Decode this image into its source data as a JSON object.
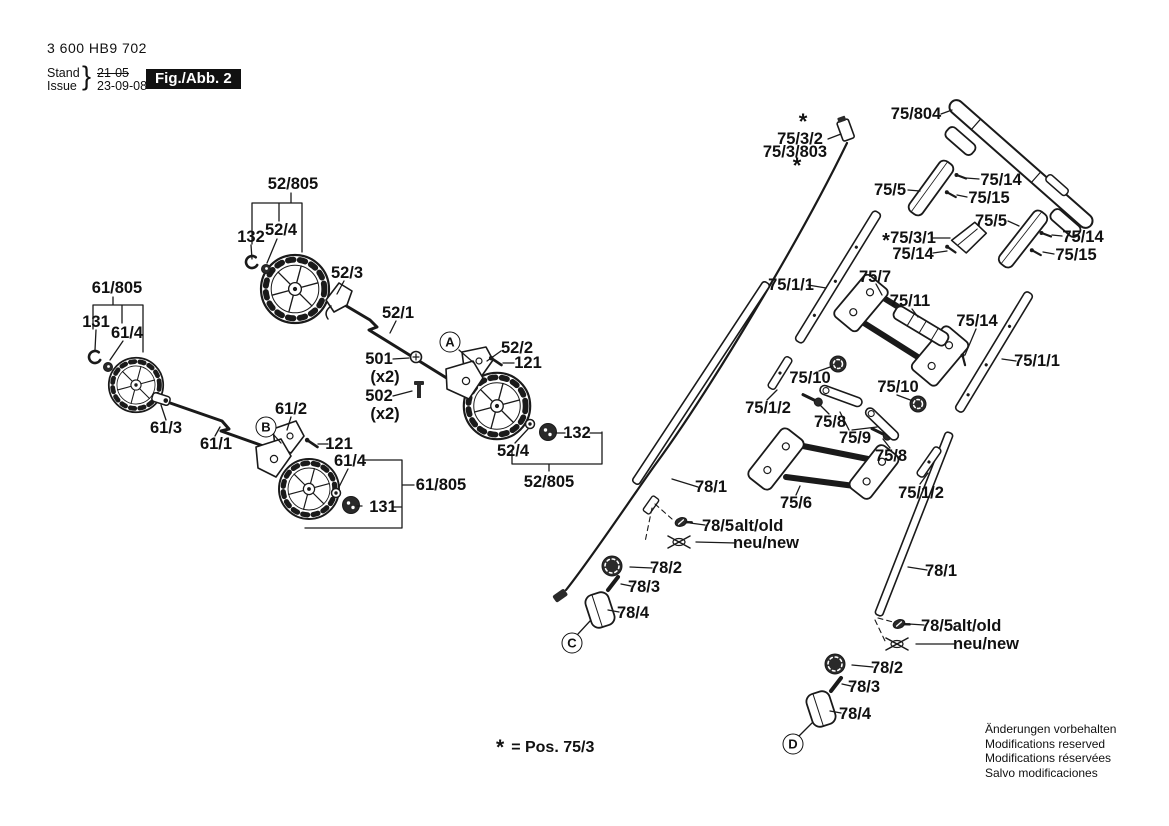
{
  "header": {
    "part_number": "3 600 HB9 702",
    "stand_label": "Stand",
    "issue_label": "Issue",
    "brace": "}",
    "stand_value": "21-05",
    "issue_value": "23-09-08",
    "figure_label": "Fig./Abb. 2"
  },
  "legend": {
    "symbol": "*",
    "text": "= Pos. 75/3"
  },
  "notes": [
    "Änderungen vorbehalten",
    "Modifications reserved",
    "Modifications réservées",
    "Salvo modificaciones"
  ],
  "colors": {
    "ink": "#1a1a1a",
    "figure_box_bg": "#111111"
  },
  "callouts": [
    {
      "letter": "A",
      "x": 450,
      "y": 342
    },
    {
      "letter": "B",
      "x": 266,
      "y": 427
    },
    {
      "letter": "C",
      "x": 572,
      "y": 643
    },
    {
      "letter": "D",
      "x": 793,
      "y": 744
    }
  ],
  "labels": [
    {
      "text": "52/805",
      "x": 293,
      "y": 184
    },
    {
      "text": "132",
      "x": 251,
      "y": 237
    },
    {
      "text": "52/4",
      "x": 281,
      "y": 230
    },
    {
      "text": "52/3",
      "x": 347,
      "y": 273
    },
    {
      "text": "52/1",
      "x": 398,
      "y": 313
    },
    {
      "text": "501",
      "x": 379,
      "y": 359
    },
    {
      "text": "(x2)",
      "x": 385,
      "y": 377
    },
    {
      "text": "502",
      "x": 379,
      "y": 396
    },
    {
      "text": "(x2)",
      "x": 385,
      "y": 414
    },
    {
      "text": "52/2",
      "x": 517,
      "y": 348
    },
    {
      "text": "121",
      "x": 528,
      "y": 363
    },
    {
      "text": "132",
      "x": 577,
      "y": 433
    },
    {
      "text": "52/4",
      "x": 513,
      "y": 451
    },
    {
      "text": "52/805",
      "x": 549,
      "y": 482
    },
    {
      "text": "61/805",
      "x": 117,
      "y": 288
    },
    {
      "text": "131",
      "x": 96,
      "y": 322
    },
    {
      "text": "61/4",
      "x": 127,
      "y": 333
    },
    {
      "text": "61/3",
      "x": 166,
      "y": 428
    },
    {
      "text": "61/1",
      "x": 216,
      "y": 444
    },
    {
      "text": "61/2",
      "x": 291,
      "y": 409
    },
    {
      "text": "121",
      "x": 339,
      "y": 444
    },
    {
      "text": "61/4",
      "x": 350,
      "y": 461
    },
    {
      "text": "61/805",
      "x": 441,
      "y": 485
    },
    {
      "text": "131",
      "x": 383,
      "y": 507
    },
    {
      "text": "*",
      "x": 803,
      "y": 122,
      "size": 22
    },
    {
      "text": "75/3/2",
      "x": 800,
      "y": 139
    },
    {
      "text": "75/3/803",
      "x": 795,
      "y": 152
    },
    {
      "text": "*",
      "x": 797,
      "y": 166,
      "size": 22
    },
    {
      "text": "75/804",
      "x": 916,
      "y": 114
    },
    {
      "text": "75/5",
      "x": 890,
      "y": 190
    },
    {
      "text": "75/14",
      "x": 1001,
      "y": 180
    },
    {
      "text": "75/15",
      "x": 989,
      "y": 198
    },
    {
      "text": "75/5",
      "x": 991,
      "y": 221
    },
    {
      "text": "*",
      "x": 886,
      "y": 241,
      "size": 20
    },
    {
      "text": "75/3/1",
      "x": 913,
      "y": 238
    },
    {
      "text": "75/14",
      "x": 913,
      "y": 254
    },
    {
      "text": "75/14",
      "x": 1083,
      "y": 237
    },
    {
      "text": "75/15",
      "x": 1076,
      "y": 255
    },
    {
      "text": "75/7",
      "x": 875,
      "y": 277
    },
    {
      "text": "75/11",
      "x": 910,
      "y": 301
    },
    {
      "text": "75/1/1",
      "x": 791,
      "y": 285
    },
    {
      "text": "75/14",
      "x": 977,
      "y": 321
    },
    {
      "text": "75/1/1",
      "x": 1037,
      "y": 361
    },
    {
      "text": "75/10",
      "x": 810,
      "y": 378
    },
    {
      "text": "75/10",
      "x": 898,
      "y": 387
    },
    {
      "text": "75/1/2",
      "x": 768,
      "y": 408
    },
    {
      "text": "75/8",
      "x": 830,
      "y": 422
    },
    {
      "text": "75/9",
      "x": 855,
      "y": 438
    },
    {
      "text": "75/8",
      "x": 891,
      "y": 456
    },
    {
      "text": "75/6",
      "x": 796,
      "y": 503
    },
    {
      "text": "75/1/2",
      "x": 921,
      "y": 493
    },
    {
      "text": "78/1",
      "x": 711,
      "y": 487
    },
    {
      "text": "78/5",
      "x": 718,
      "y": 526
    },
    {
      "text": "alt/old",
      "x": 759,
      "y": 526
    },
    {
      "text": "neu/new",
      "x": 766,
      "y": 543
    },
    {
      "text": "78/2",
      "x": 666,
      "y": 568
    },
    {
      "text": "78/3",
      "x": 644,
      "y": 587
    },
    {
      "text": "78/4",
      "x": 633,
      "y": 613
    },
    {
      "text": "78/1",
      "x": 941,
      "y": 571
    },
    {
      "text": "78/5",
      "x": 937,
      "y": 626
    },
    {
      "text": "alt/old",
      "x": 977,
      "y": 626
    },
    {
      "text": "neu/new",
      "x": 986,
      "y": 644
    },
    {
      "text": "78/2",
      "x": 887,
      "y": 668
    },
    {
      "text": "78/3",
      "x": 864,
      "y": 687
    },
    {
      "text": "78/4",
      "x": 855,
      "y": 714
    }
  ]
}
